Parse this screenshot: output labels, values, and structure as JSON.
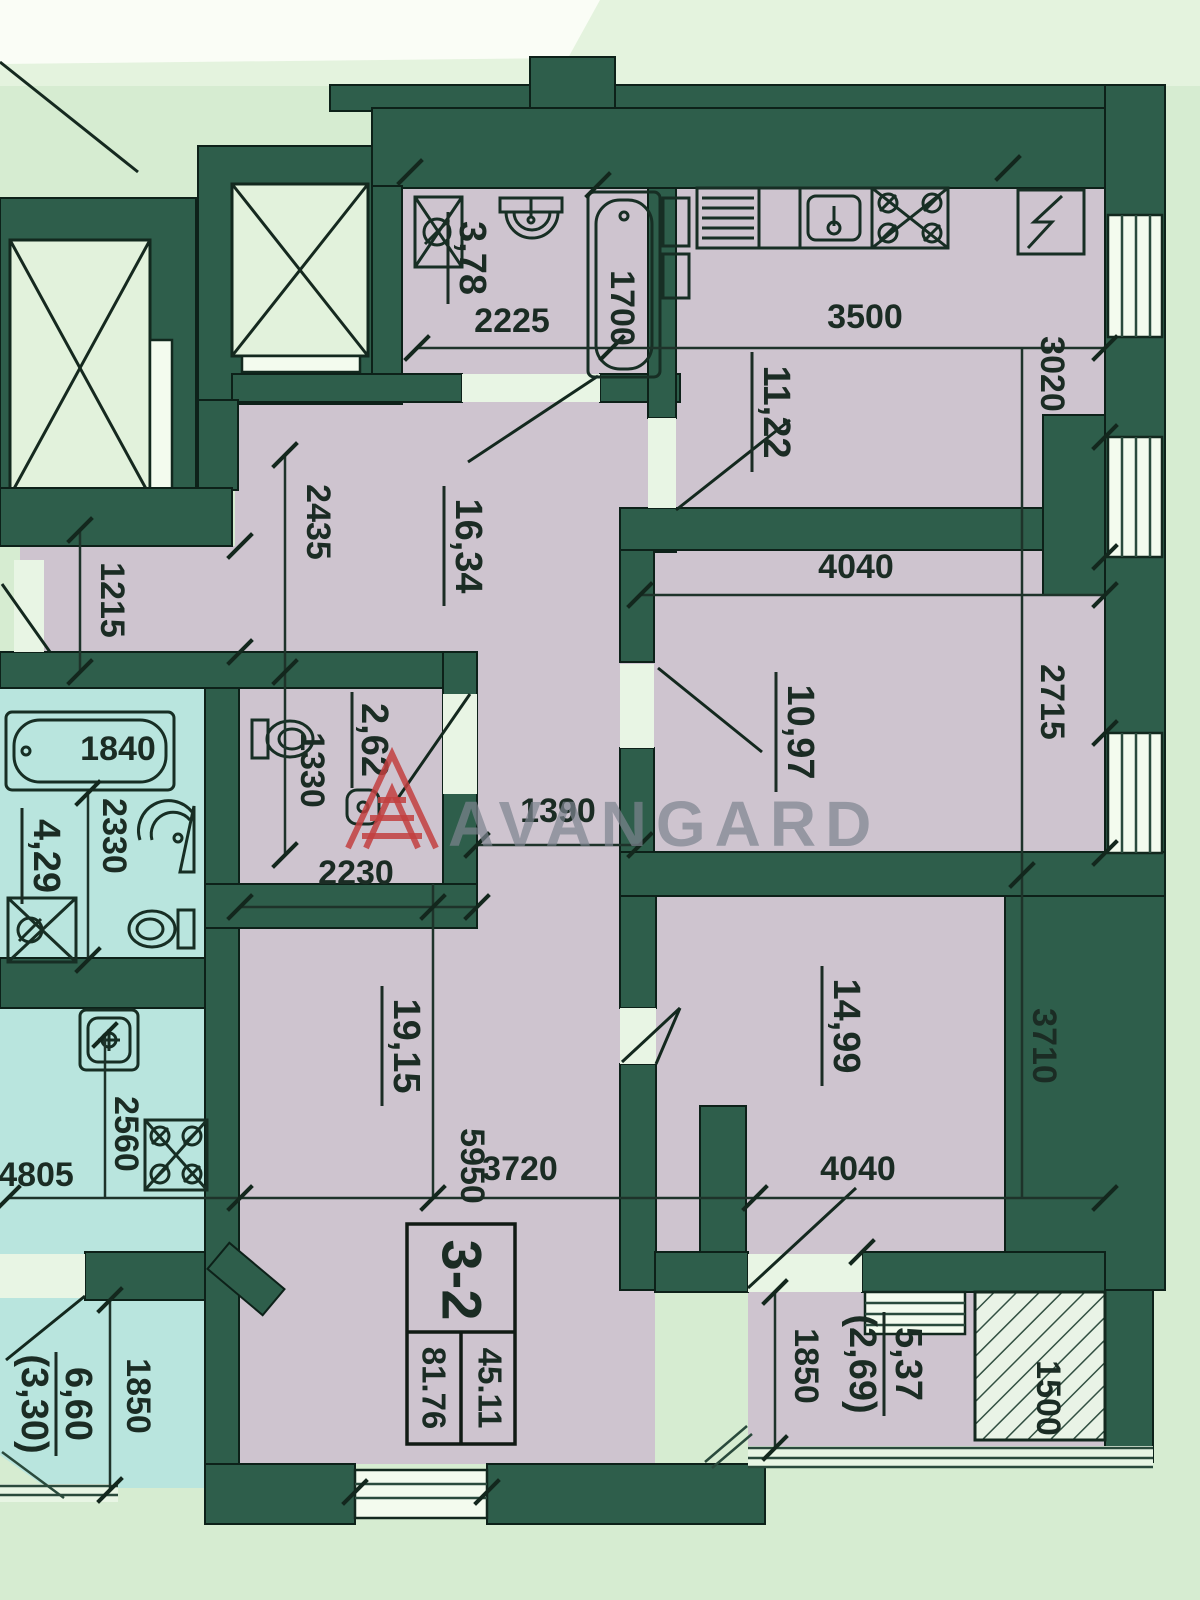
{
  "watermark": {
    "brand": "AVANGARD"
  },
  "stamp": {
    "unit": "3-2",
    "living_area": "45.11",
    "total_area": "81.76"
  },
  "apartment": {
    "bathroom": {
      "area": "3,78",
      "width": "2225",
      "tub": "1700"
    },
    "kitchen": {
      "area": "11,22",
      "width": "3500",
      "depth": "3020"
    },
    "room_top": {
      "area": "10,97",
      "width": "4040",
      "depth": "2715"
    },
    "room_bottom": {
      "area": "14,99",
      "width": "4040",
      "depth": "3710"
    },
    "hallway": {
      "area": "16,34",
      "width": "2435",
      "entry": "1215",
      "passage": "1390"
    },
    "wc": {
      "area": "2,62",
      "width": "1330"
    },
    "living": {
      "area": "19,15",
      "top_width": "2230",
      "length": "5950",
      "bottom_width": "3720"
    },
    "balcony": {
      "area": "5,37",
      "area_cold": "(2,69)",
      "depth": "1850",
      "width": "1500"
    }
  },
  "neighbor": {
    "bathroom": {
      "area": "4,29",
      "tub": "1840",
      "width": "2330"
    },
    "kitchen": {
      "depth": "2560",
      "width": "4805"
    },
    "balcony": {
      "area": "6,60",
      "area_cold": "(3,30)",
      "depth": "1850"
    }
  }
}
